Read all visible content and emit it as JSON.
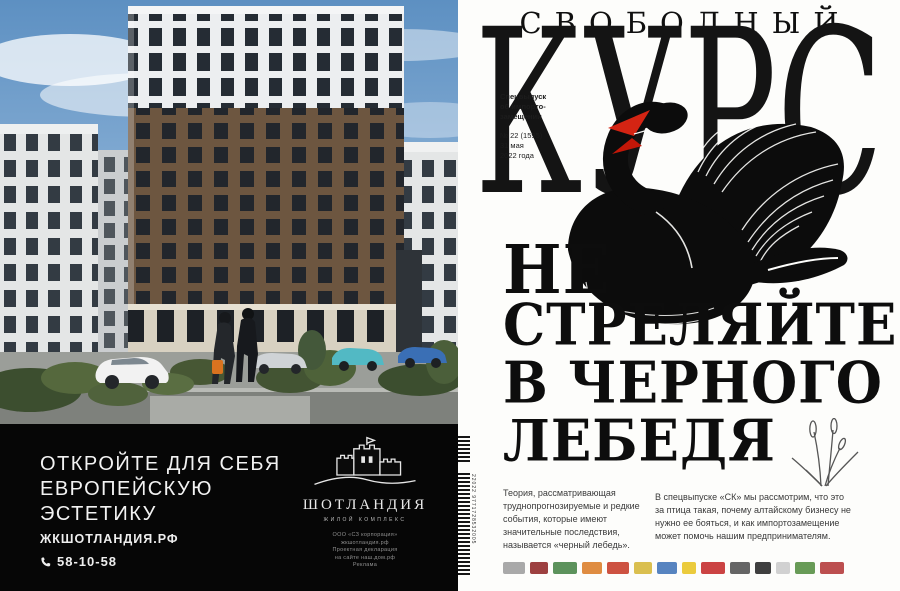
{
  "left_ad": {
    "headline_lines": [
      "ОТКРОЙТЕ ДЛЯ СЕБЯ",
      "ЕВРОПЕЙСКУЮ",
      "ЭСТЕТИКУ"
    ],
    "website": "ЖКШОТЛАНДИЯ.РФ",
    "phone": "58-10-58",
    "brand": {
      "name": "ШОТЛАНДИЯ",
      "subtitle": "ЖИЛОЙ КОМПЛЕКС"
    },
    "disclaimer_lines": [
      "ООО «СЗ корпорация»",
      "жкшотландия.рф",
      "Проектная декларация",
      "на сайте наш.дом.рф",
      "Реклама"
    ],
    "colors": {
      "band_bg": "#060606",
      "text": "#f2f2f2"
    }
  },
  "cover": {
    "masthead_top": "СВОБОДНЫЙ",
    "masthead_main": "КУРС",
    "issue": {
      "line1": "Спецвыпуск",
      "line2": "об импорто-",
      "line3": "замещении",
      "number": "№ 22 (1595)",
      "date1": "31 мая",
      "date2": "2022 года"
    },
    "headline_lines": [
      "НЕ",
      "СТРЕЛЯЙТЕ",
      "В ЧЕРНОГО",
      "ЛЕБЕДЯ"
    ],
    "lede_left": "Теория, рассматривающая труднопрогнозируемые и редкие события, которые имеют значительные последствия, называется «черный лебедь».",
    "lede_right": "В спецвыпуске «СК» мы рассмотрим, что это за птица такая, почему алтайскому бизнесу не нужно ее бояться, и как импортозамещение может помочь нашим предпринимателям.",
    "barcode": {
      "main_digits": "9771728532005",
      "addon_digits": "22022"
    },
    "colors": {
      "ink": "#141414",
      "beak_red": "#d42413",
      "paper": "#fdfdfb"
    },
    "sponsor_logos": [
      {
        "color": "#9a9a9a",
        "width": 22
      },
      {
        "color": "#8c1f1f",
        "width": 18
      },
      {
        "color": "#3f7f3f",
        "width": 24
      },
      {
        "color": "#d97820",
        "width": 20
      },
      {
        "color": "#c43420",
        "width": 22
      },
      {
        "color": "#d4b430",
        "width": 18
      },
      {
        "color": "#3a6fb5",
        "width": 20
      },
      {
        "color": "#e8c21a",
        "width": 14
      },
      {
        "color": "#c22222",
        "width": 24
      },
      {
        "color": "#4a4a4a",
        "width": 20
      },
      {
        "color": "#1d1d1d",
        "width": 16
      },
      {
        "color": "#c9c9c9",
        "width": 14
      },
      {
        "color": "#4d8a3a",
        "width": 20
      },
      {
        "color": "#b03030",
        "width": 24
      }
    ]
  }
}
